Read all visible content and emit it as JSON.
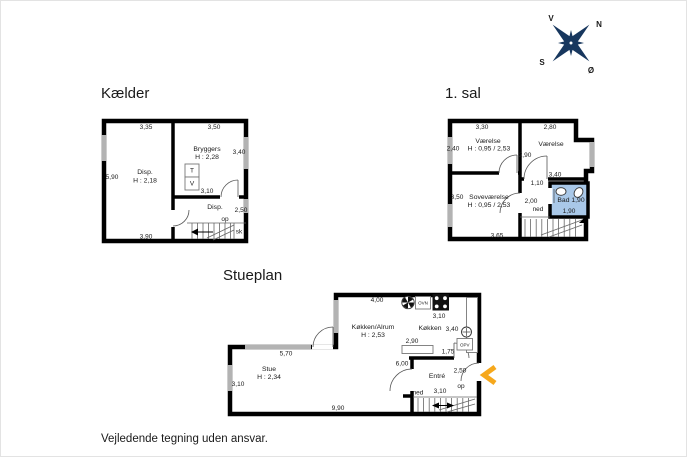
{
  "meta": {
    "disclaimer": "Vejledende tegning uden ansvar."
  },
  "compass": {
    "north": "N",
    "south": "S",
    "west": "V",
    "east": "Ø"
  },
  "colors": {
    "bath_fill": "#a9c8e8",
    "arrow": "#f6a81c",
    "compass": "#17375e",
    "window": "#b3b3b3"
  },
  "kaelder": {
    "title": "Kælder",
    "dim_top_left": "3,35",
    "dim_top_right": "3,50",
    "dim_right": "3,40",
    "dim_left": "5,90",
    "dim_mid": "3,10",
    "dim_lower_right": "2,50",
    "dim_bottom": "3,90",
    "room_disp1_name": "Disp.",
    "room_disp1_h": "H : 2,18",
    "room_bryggers_name": "Bryggers",
    "room_bryggers_h": "H : 2,28",
    "room_disp2_name": "Disp.",
    "appliance_t": "T",
    "appliance_v": "V",
    "stairs_up": "op",
    "closet": "sk"
  },
  "forstesal": {
    "title": "1. sal",
    "dim_top_left": "3,30",
    "dim_top_right": "2,80",
    "dim_mid": "2,90",
    "dim_bath_top": "3,40",
    "dim_opening": "1,10",
    "dim_hall": "2,00",
    "dim_left": "3,50",
    "dim_bottom": "3,65",
    "room1_name": "Værelse",
    "room1_dim": "2,40",
    "room1_h": "H : 0,95 / 2,53",
    "room2_name": "Værelse",
    "room3_name": "Soveværelse",
    "room3_h": "H : 0,95 / 2,53",
    "bath_name": "Bad 1,90",
    "bath_dim": "1,90",
    "stairs_down": "ned"
  },
  "stueplan": {
    "title": "Stueplan",
    "dim_top": "4,00",
    "oven_label": "OVN",
    "dim_stove": "3,10",
    "room_kitchen_alrum": "Køkken/Alrum",
    "room_kitchen_alrum_h": "H : 2,53",
    "room_kitchen": "Køkken",
    "dim_sink": "3,40",
    "dishwasher_label": "OPV",
    "dim_island": "2,90",
    "dim_entry_door": "1,75",
    "dim_hall": "6,00",
    "dim_entrance": "2,50",
    "dim_window": "5,70",
    "room_stue": "Stue",
    "room_stue_h": "H : 2,34",
    "dim_left": "3,10",
    "dim_bottom": "9,90",
    "room_entre": "Entré",
    "stairs_down": "ned",
    "dim_stairs": "3,10",
    "stairs_up": "op"
  }
}
